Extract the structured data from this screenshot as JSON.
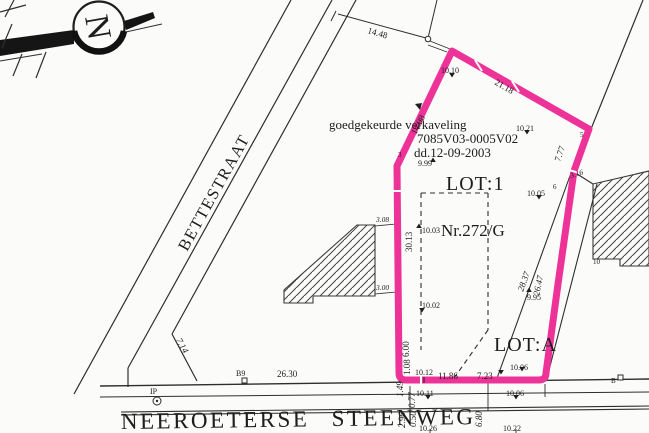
{
  "colors": {
    "highlight": "#ee3398",
    "ink": "#2e2e2e",
    "paper": "#fbfbfa"
  },
  "compass": {
    "north_label": "N"
  },
  "streets": {
    "side_street": "BETTESTRAAT",
    "main_street": "NEEROETERSE STEENWEG"
  },
  "approval_note": {
    "line1": "goedgekeurde verkaveling",
    "line2": "7085V03-0005V02",
    "line3": "dd.12-09-2003"
  },
  "parcels": {
    "lot1_label": "LOT:1",
    "lot1_parcel_number": "Nr.272/G",
    "lotA_label": "LOT:A",
    "neighbor_parcel": "ex.Nr."
  },
  "boundary_points": {
    "p3": "3",
    "p5": "5",
    "p6": "6",
    "p10": "10",
    "b9": "B9",
    "b": "B",
    "ip": "IP"
  },
  "dimensions": {
    "d14_48": "14.48",
    "d14_98": "14.98",
    "d21_18": "21.18",
    "d7_77": "7.77",
    "d3_16": "3.16",
    "d30_13": "30.13",
    "d3_08": "3.08",
    "d3_00": "3.00",
    "d28_37": "28.37",
    "d26_47": "26.47",
    "d7_14": "7.14",
    "d26_30": "26.30",
    "d11_86": "11.86",
    "d7_23": "7.23",
    "d6_00": "6.00",
    "d1_08": "1.08",
    "d1_49": "1.49",
    "d0_77": "0.77",
    "d2_96": "2.96",
    "d0_50": "0.50",
    "d6_80": "6.80"
  },
  "spot_heights": {
    "s10_10": "10.10",
    "s10_21": "10.21",
    "s9_99": "9.99",
    "s10_05": "10.05",
    "s10_03": "10.03",
    "s10_02": "10.02",
    "s9_95": "9.95",
    "s10_12": "10.12",
    "s10_06a": "10.06",
    "s10_11": "10.11",
    "s10_06b": "10.06",
    "s10_26": "10.26",
    "s10_22": "10.22"
  }
}
